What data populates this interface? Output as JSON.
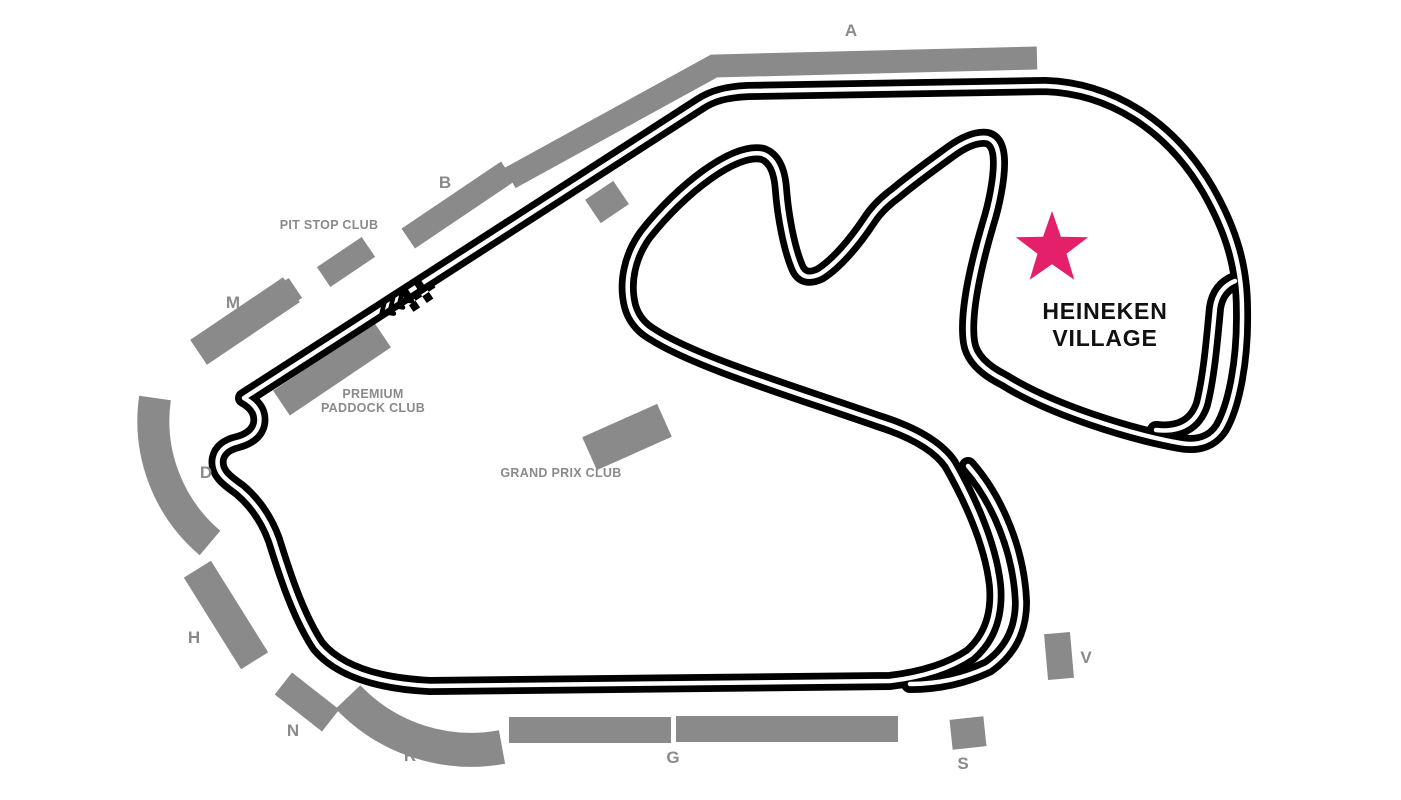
{
  "map": {
    "stands": {
      "a": "A",
      "b": "B",
      "m": "M",
      "d": "D",
      "h": "H",
      "n": "N",
      "r": "R",
      "g": "G",
      "s": "S",
      "v": "V"
    },
    "clubs": {
      "pit_stop": "PIT STOP CLUB",
      "premium_paddock_line1": "PREMIUM",
      "premium_paddock_line2": "PADDOCK CLUB",
      "grand_prix": "GRAND PRIX CLUB"
    },
    "village": {
      "line1": "HEINEKEN",
      "line2": "VILLAGE"
    },
    "icons": {
      "village_marker": "star-icon",
      "start_finish": "checkered-flag-icon",
      "race_direction": "chevron-arrows-icon"
    },
    "colors": {
      "background": "#ffffff",
      "stand_gray": "#8a8a8a",
      "label_gray": "#8a8a8a",
      "track_black": "#000000",
      "track_centerline": "#ffffff",
      "star_pink": "#e32069",
      "village_text": "#111111"
    }
  }
}
